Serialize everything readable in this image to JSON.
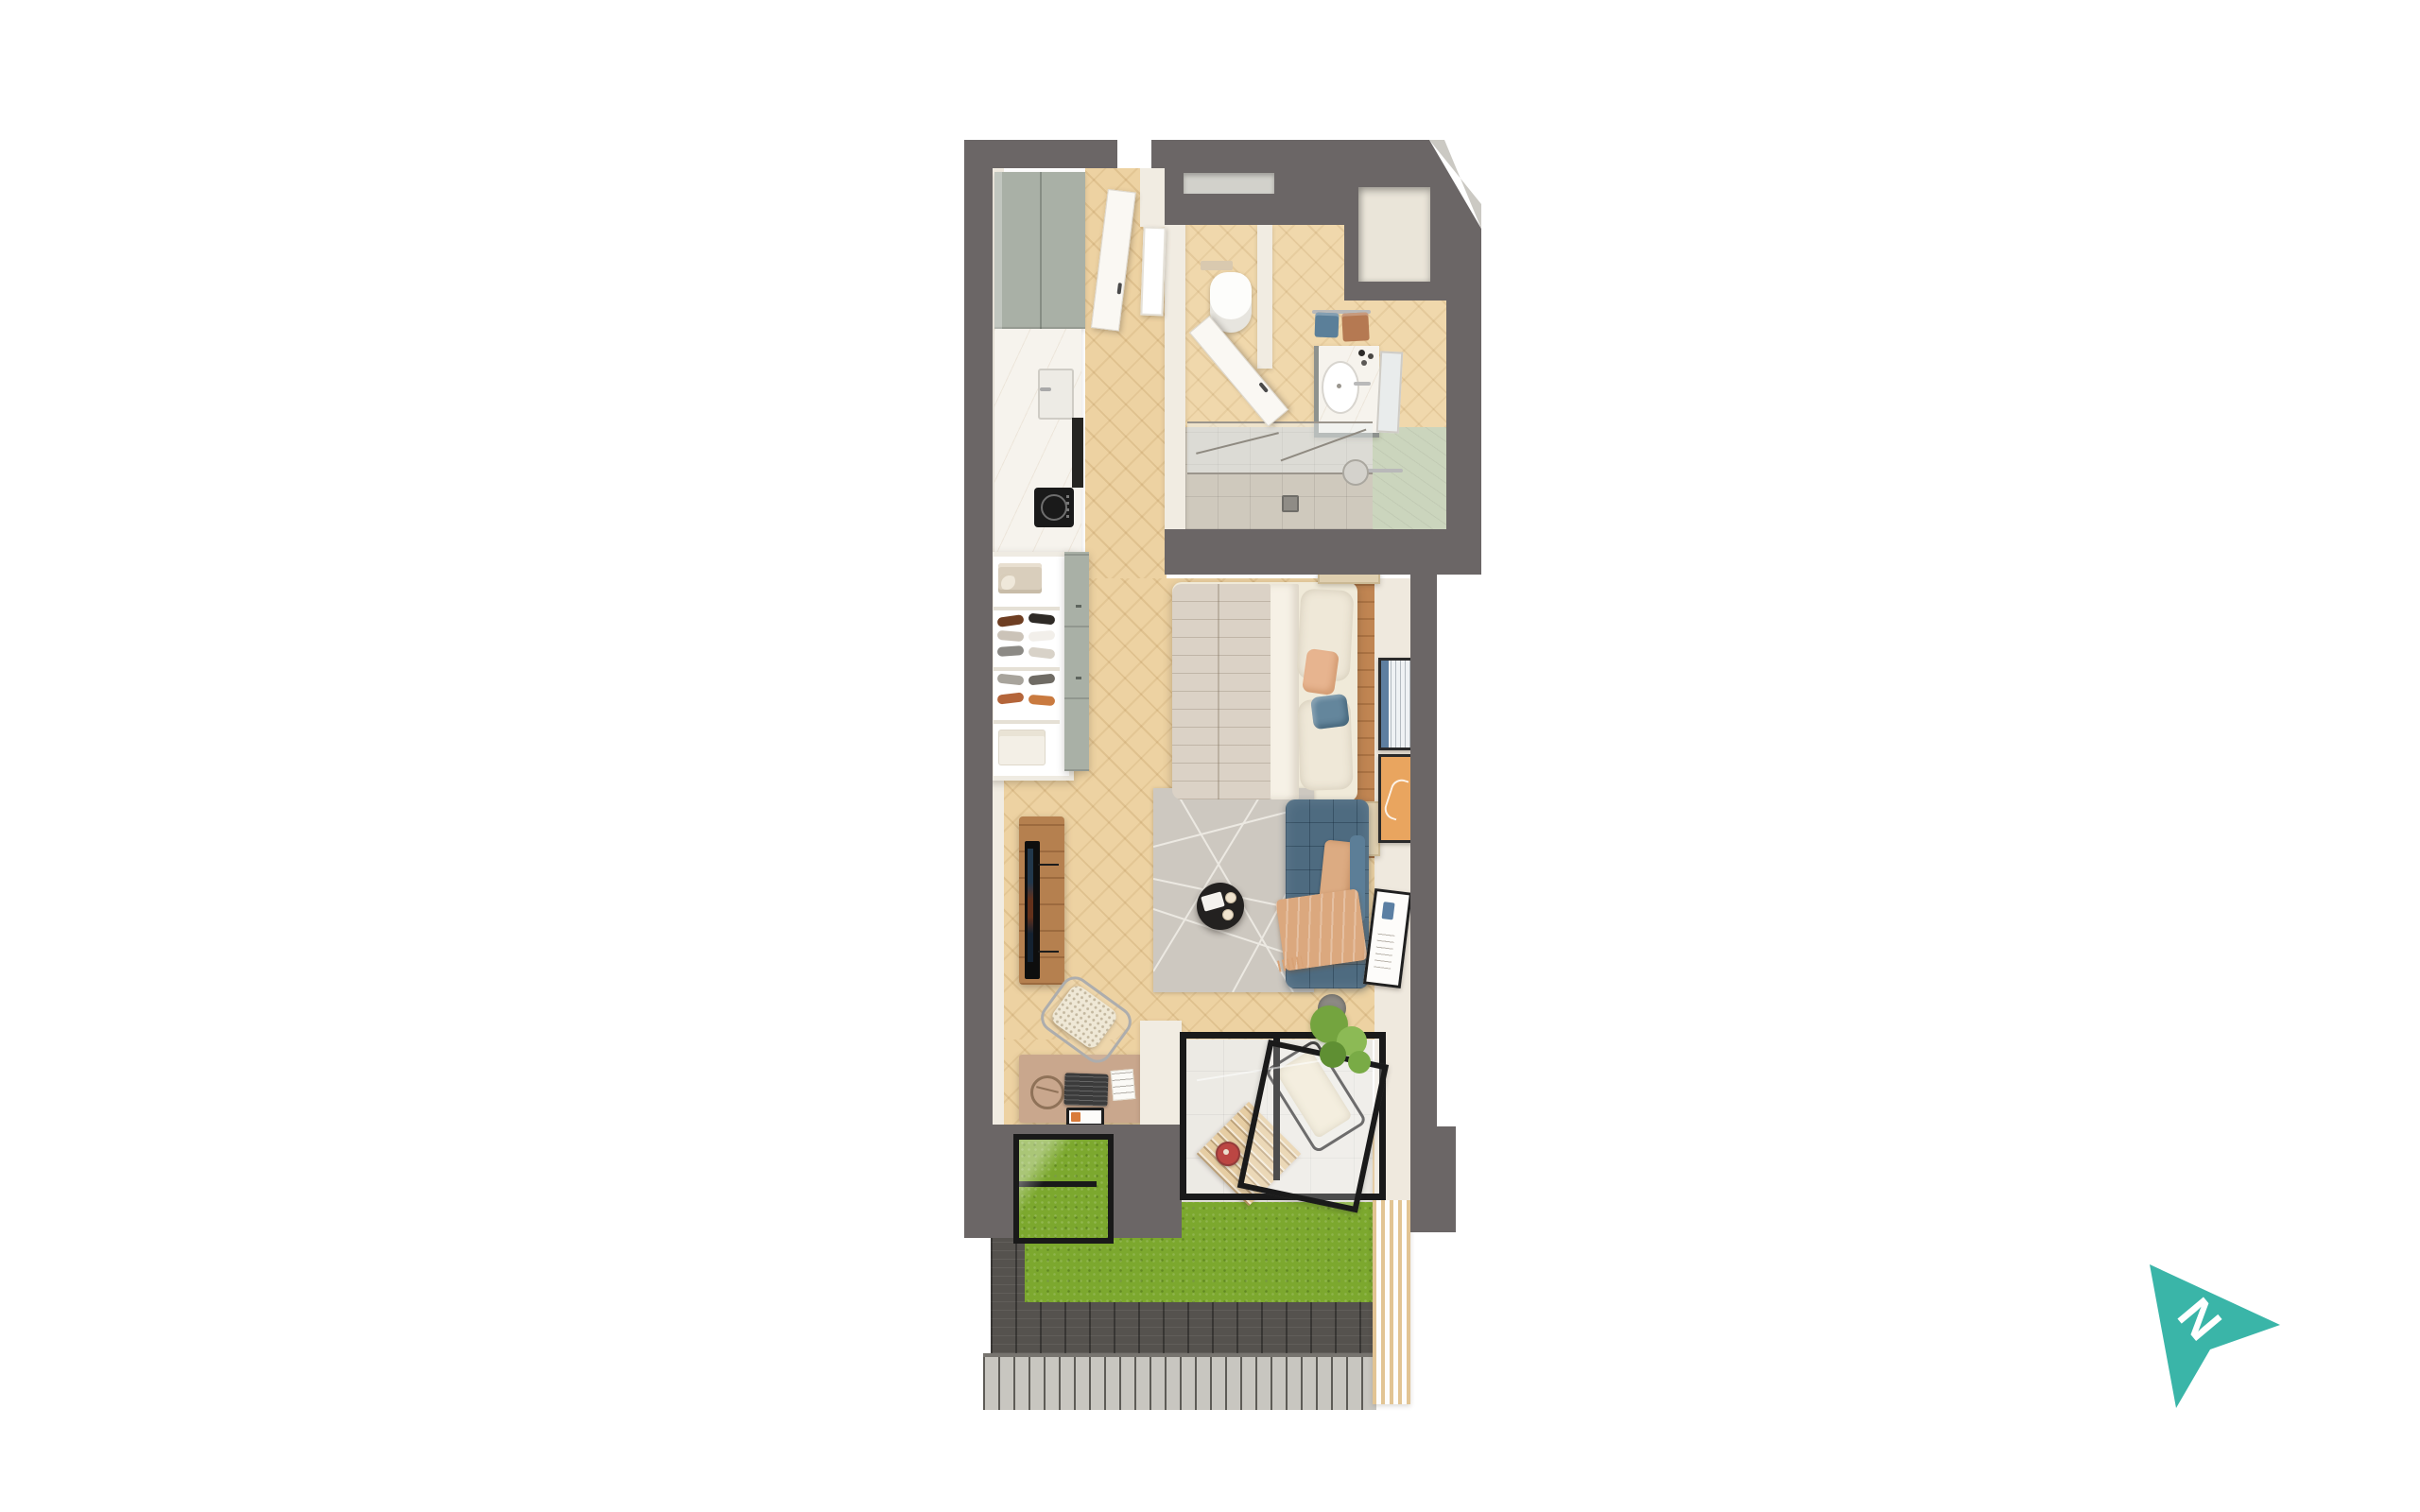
{
  "image": {
    "type": "3d-floor-plan-rendering",
    "description": "Top-down 3D render of a studio apartment with private terrace",
    "background": "#ffffff"
  },
  "compass": {
    "label": "N",
    "color": "#3AB5A8",
    "letter_color": "#FFFFFF",
    "direction": "upper-right"
  },
  "palette": {
    "wall_gray": "#6B6666",
    "inner_wall_cream": "#F1ECE2",
    "wood_floor": "#EDD2A2",
    "headboard_wood": "#C08552",
    "cabinet_sage": "#A9B0A6",
    "marble_counter": "#F6F3ED",
    "shower_tile": "#CFC9BD",
    "green_wall_tile": "#CBD5BD",
    "sofa_blue": "#4E6B80",
    "throw_peach": "#DBA87E",
    "rug_gray": "#CDC8C0",
    "coffee_table_black": "#232120",
    "tv_console_wood": "#B5804F",
    "desk_tan": "#C9A78D",
    "grass_green": "#7CA82E",
    "paving_stone": "#EAE7DF",
    "brick_border": "#55524E",
    "decking_gray": "#C8C6C0",
    "slat_screen_wood": "#E2C493",
    "door_frame_black": "#1A1A1A",
    "accent_red_teapot": "#AF1F1A"
  },
  "apartment": {
    "rooms": [
      {
        "name": "entrance-hall",
        "floor": "herringbone-wood",
        "features": [
          "front-door-open",
          "leaning-mirror",
          "bathroom-door-open"
        ]
      },
      {
        "name": "bathroom",
        "floor": "wood-and-tile",
        "features": [
          "toilet",
          "flush-plate",
          "privacy-partition",
          "vanity-with-basin",
          "faucet",
          "toiletry-bottles",
          "leaning-mirror",
          "towel-rail",
          "blue-towel",
          "brown-towel",
          "walk-in-shower",
          "glass-shower-screen",
          "rain-shower-bar",
          "floor-drain",
          "green-tiled-wall",
          "wall-niche",
          "transom-window"
        ]
      },
      {
        "name": "kitchen",
        "features": [
          "tall-sage-cabinets",
          "marble-worktop",
          "sink",
          "induction-hob",
          "built-in-oven"
        ]
      },
      {
        "name": "wardrobe",
        "features": [
          "folded-clothes-shelf",
          "shoe-shelves",
          "folded-shirt-shelf",
          "sage-drawer-unit"
        ]
      },
      {
        "name": "bedroom-living",
        "features": [
          "double-bed",
          "quilted-duvet",
          "white-sheet",
          "two-pillows",
          "peach-cushion",
          "blue-cushion",
          "headboard-wood-wall",
          "nightstand-top",
          "nightstand-bottom",
          "round-table-lamps",
          "artwork-blue-stripes",
          "artwork-orange",
          "area-rug-line-pattern",
          "blue-velvet-sofa",
          "peach-folded-cushion",
          "peach-throw-blanket",
          "round-black-coffee-table",
          "serving-tray",
          "two-cups",
          "tv",
          "tv-media-console",
          "artwork-abstract-tilted",
          "potted-plant"
        ]
      },
      {
        "name": "study-nook",
        "features": [
          "desk",
          "laptop",
          "tablet",
          "note-papers",
          "circle-desk-lamp",
          "cane-chair-chrome-frame",
          "interior-windows-over-grass"
        ]
      },
      {
        "name": "terrace",
        "features": [
          "black-framed-glazed-doors",
          "open-glass-panel",
          "stone-paving",
          "artificial-grass",
          "slatted-wood-table",
          "red-teapot",
          "lounge-chair",
          "small-tree-in-pot",
          "dark-brick-border",
          "timber-decking",
          "vertical-wood-slat-screen"
        ]
      }
    ]
  }
}
